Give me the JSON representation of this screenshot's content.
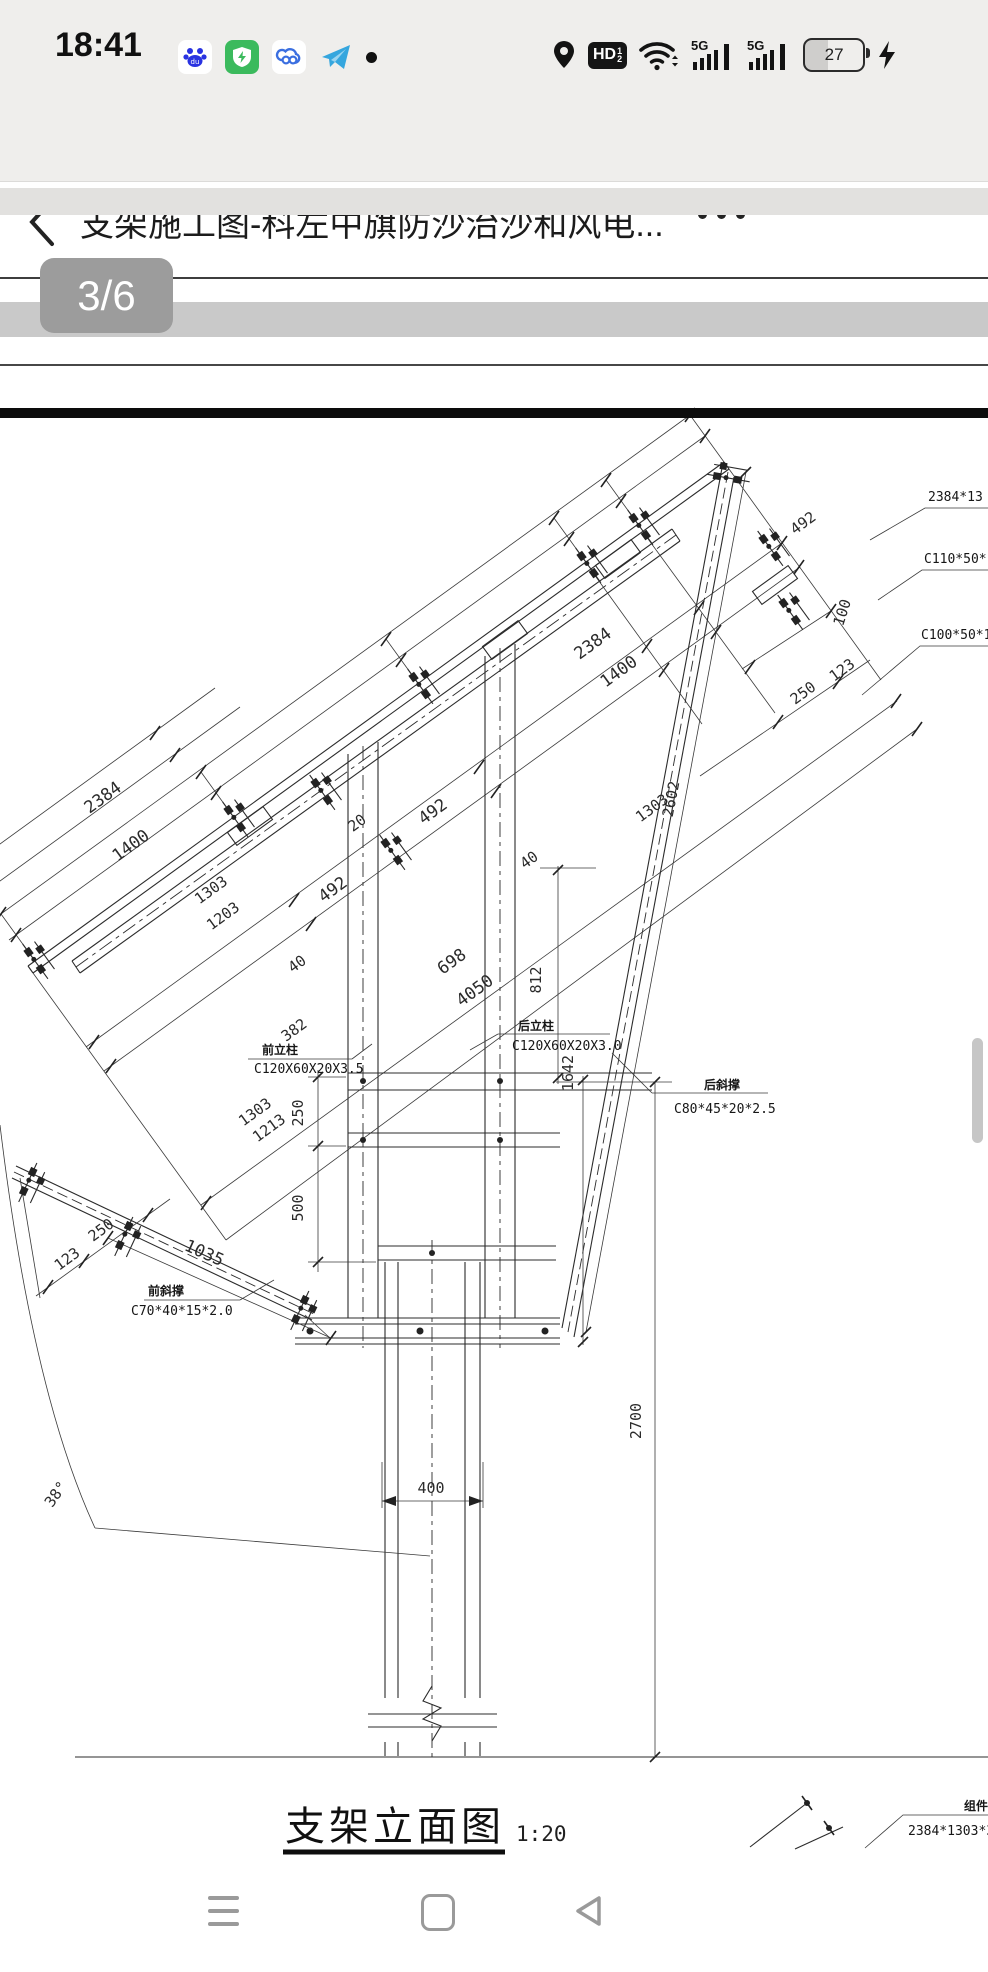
{
  "status_bar": {
    "time": "18:41",
    "battery_level": "27",
    "hd_label": "HD",
    "hd_sup": "1",
    "hd_sub": "2",
    "net_label_1": "5G",
    "net_label_2": "5G",
    "icons": [
      "baidu-app-icon",
      "security-shield-icon",
      "baidu-cloud-icon",
      "telegram-icon",
      "notification-dot",
      "location-icon",
      "hd-voice-icon",
      "wifi-icon",
      "signal-5g-icon",
      "signal-5g-icon",
      "battery-icon",
      "charging-bolt-icon"
    ]
  },
  "nav_bar": {
    "title": "支架施工图-科左中旗防沙治沙和风电...",
    "icons": [
      "back-chevron-icon",
      "more-ellipsis-icon"
    ]
  },
  "page_indicator": "3/6",
  "drawing": {
    "caption": "支架立面图",
    "scale_label": "1:20",
    "angle_label": "38°",
    "component_label": {
      "name": "组件",
      "spec": "2384*1303*35"
    },
    "callouts": [
      "2384*13",
      "C110*50*15",
      "C100*50*15"
    ],
    "part_labels": [
      {
        "name": "前立柱",
        "spec": "C120X60X20X3.5"
      },
      {
        "name": "后立柱",
        "spec": "C120X60X20X3.0"
      },
      {
        "name": "前斜撑",
        "spec": "C70*40*15*2.0"
      },
      {
        "name": "后斜撑",
        "spec": "C80*45*20*2.5"
      }
    ],
    "dimensions": [
      "100",
      "123",
      "250",
      "492",
      "2384",
      "1400",
      "1303",
      "2602",
      "492",
      "492",
      "20",
      "40",
      "40",
      "698",
      "4050",
      "812",
      "1642",
      "382",
      "2384",
      "1400",
      "1303",
      "1203",
      "1303",
      "1213",
      "250",
      "500",
      "123",
      "250",
      "1035",
      "38°",
      "400",
      "2700"
    ]
  },
  "bottom_nav": {
    "icons": [
      "recents-menu-icon",
      "home-square-icon",
      "back-triangle-icon"
    ]
  }
}
